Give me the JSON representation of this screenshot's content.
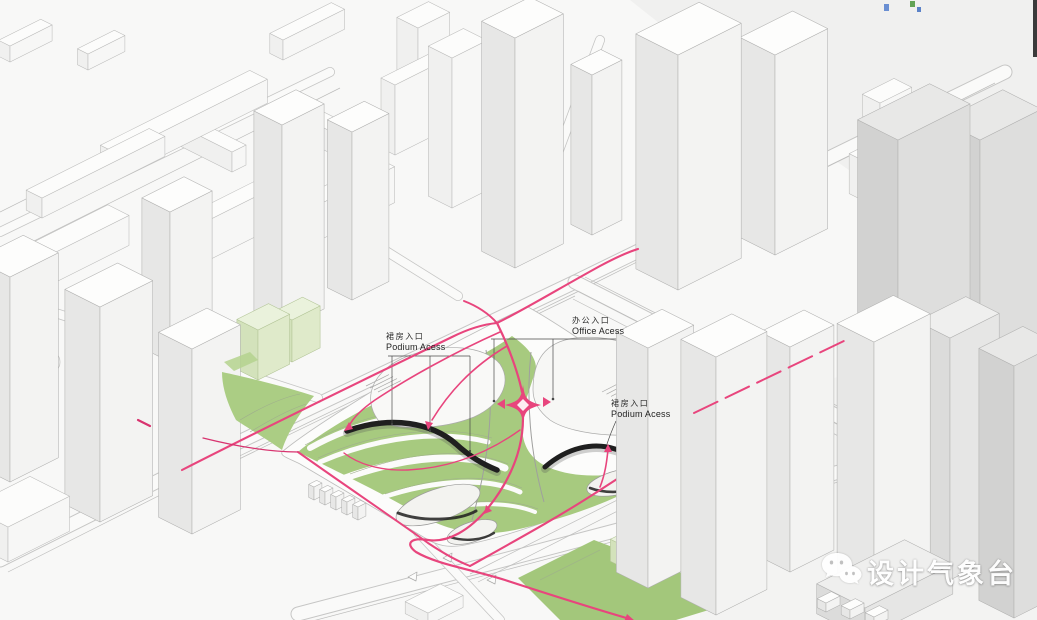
{
  "meta": {
    "title": "Site Access and Circulation Axonometric Diagram"
  },
  "colors": {
    "accent_pink": "#e8457d",
    "deep_pink": "#d8336f",
    "site_green": "#a7ca7f",
    "park_green": "#abcd84",
    "pale_green_building": "#eaf2dc",
    "building_top": "#fdfdfc",
    "building_side": "#e7e7e6",
    "gray_slab": "#dcdcdb",
    "outline": "#b1b1b0",
    "podium_dark": "#1f1f1f",
    "paper": "#f8f8f7",
    "watermark_white": "#ffffff"
  },
  "annotations": {
    "podium_access_left": {
      "zh": "裙房入口",
      "en": "Podium Acess"
    },
    "office_access": {
      "zh": "办公入口",
      "en": "Office Acess"
    },
    "podium_access_right": {
      "zh": "裙房入口",
      "en": "Podium Acess"
    }
  },
  "watermark": {
    "text": "设计气象台",
    "icon": "wechat-icon"
  }
}
